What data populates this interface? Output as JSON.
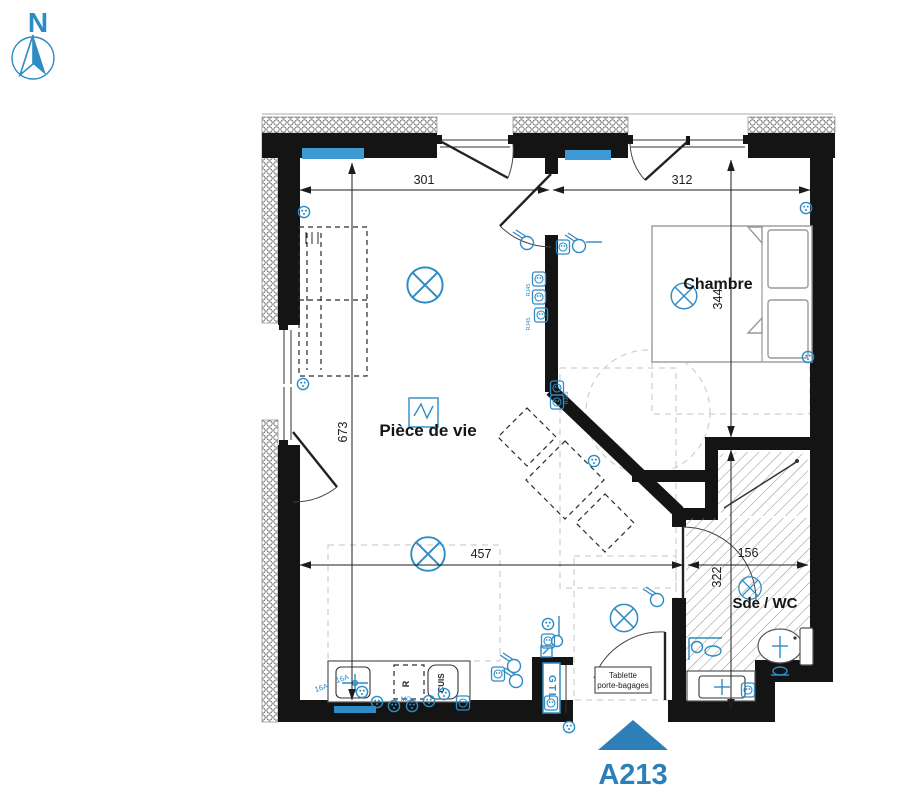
{
  "colors": {
    "accent": "#2e8bc5",
    "radiator": "#3d9ad3",
    "unit": "#2e7fb8",
    "wall": "#141414"
  },
  "compass": {
    "north_label": "N"
  },
  "rooms": {
    "living_room": "Pièce de vie",
    "bedroom": "Chambre",
    "bathroom": "Sde / WC"
  },
  "dimensions": {
    "living_width_top": "301",
    "bedroom_width_top": "312",
    "bedroom_depth": "344",
    "living_depth": "673",
    "living_width_bottom": "457",
    "bathroom_width": "156",
    "bathroom_depth": "322"
  },
  "unit_marker": {
    "id": "A213"
  },
  "annotations": {
    "gtl": "GTL",
    "shelf_line1": "Tablette",
    "shelf_line2": "porte-bagages",
    "kitchen_abbr": "CUIS",
    "fridge_abbr": "R",
    "microwave_abbr": "MO",
    "amp_rating_1": "16A",
    "amp_rating_2": "16A",
    "rj45_label_1": "RJ45",
    "rj45_label_2": "RJ45",
    "rj45_label_3": "RJ45"
  }
}
